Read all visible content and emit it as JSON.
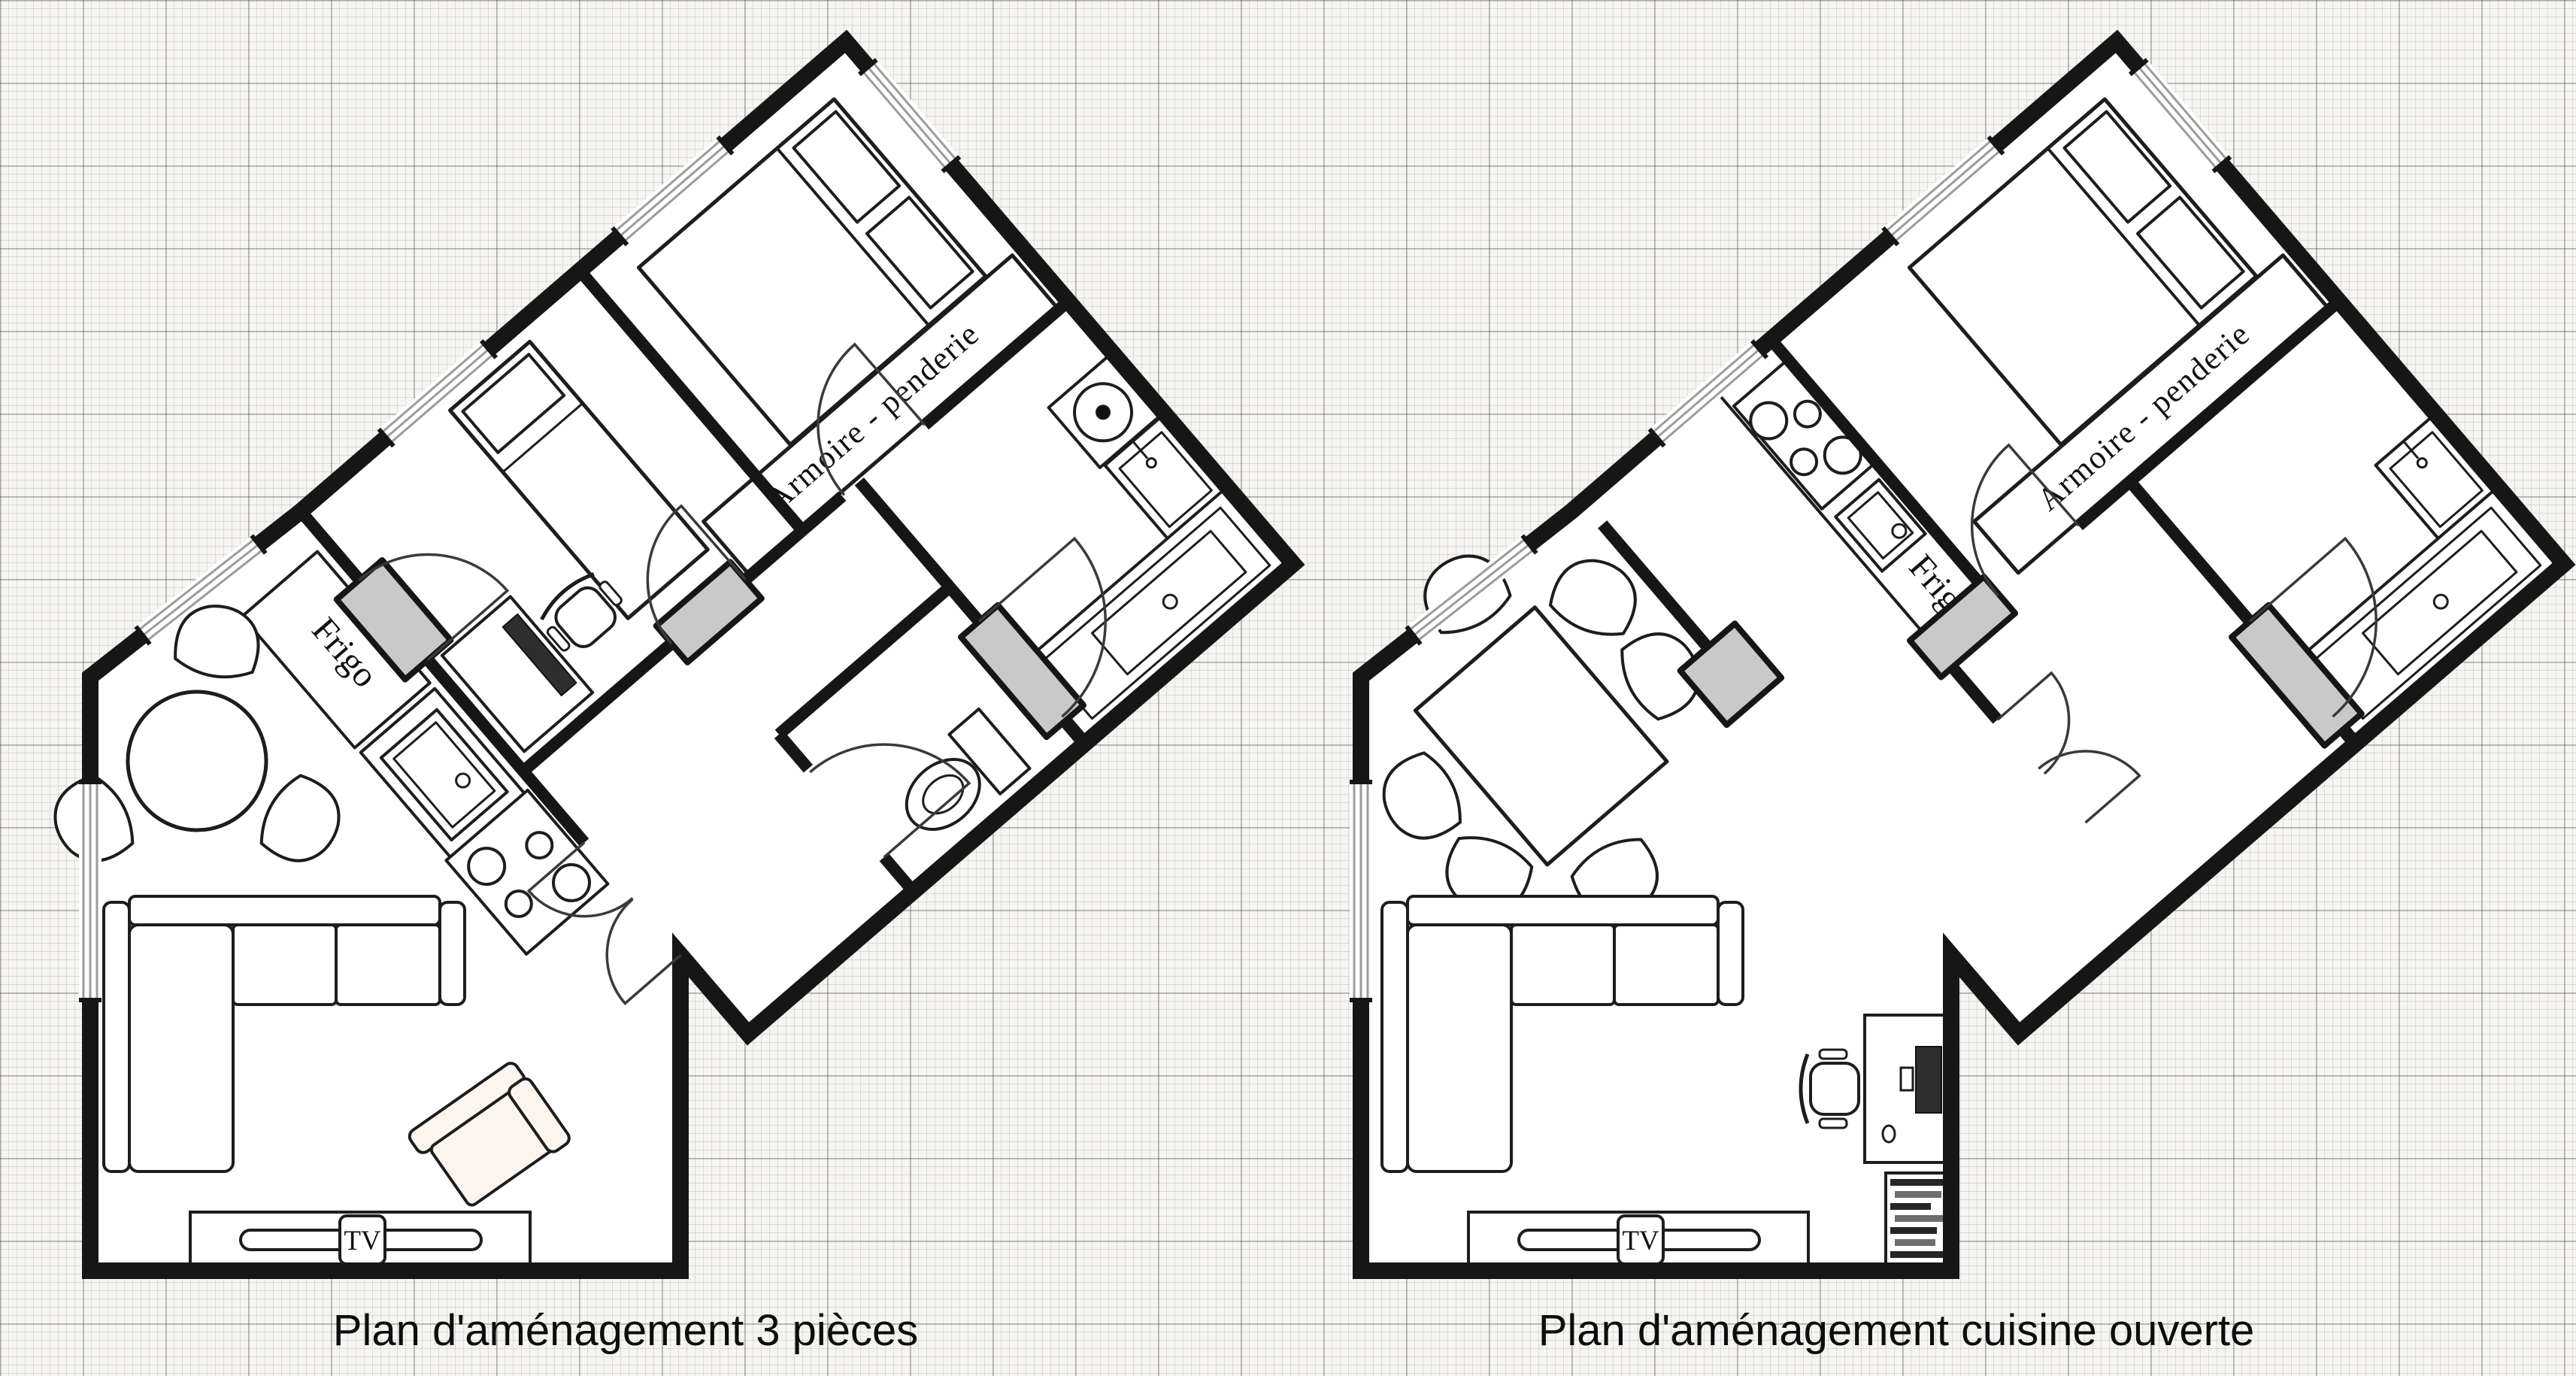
{
  "background": {
    "type": "graph-paper-grid"
  },
  "colors": {
    "paper": "#f6f5f2",
    "grid_minor": "#dddcd9",
    "grid_major": "#bdbcb8",
    "wall": "#161616",
    "door_threshold": "#c9c9c9",
    "upholstery": "#faf6ee",
    "ink": "#111111"
  },
  "plans": [
    {
      "id": "plan-3-pieces",
      "caption": "Plan d'aménagement 3 pièces",
      "labels": {
        "fridge": "Frigo",
        "wardrobe": "Armoire - penderie",
        "tv": "TV"
      },
      "furniture": [
        "double-bed",
        "wardrobe",
        "single-bed",
        "desk",
        "office-chair",
        "fridge",
        "kitchen-sink",
        "stove",
        "washing-machine",
        "washbasin",
        "bathtub",
        "toilet",
        "round-table",
        "fan-chairs",
        "corner-sofa",
        "armchair",
        "tv-stand"
      ]
    },
    {
      "id": "plan-cuisine-ouverte",
      "caption": "Plan d'aménagement cuisine ouverte",
      "labels": {
        "fridge": "Frigo",
        "wardrobe": "Armoire - penderie",
        "tv": "TV"
      },
      "furniture": [
        "double-bed",
        "wardrobe",
        "stove",
        "kitchen-sink",
        "fridge",
        "dining-table",
        "fan-chairs",
        "washbasin",
        "bathtub",
        "corner-sofa",
        "tv-stand",
        "desk",
        "office-chair",
        "computer",
        "bookshelf"
      ]
    }
  ]
}
